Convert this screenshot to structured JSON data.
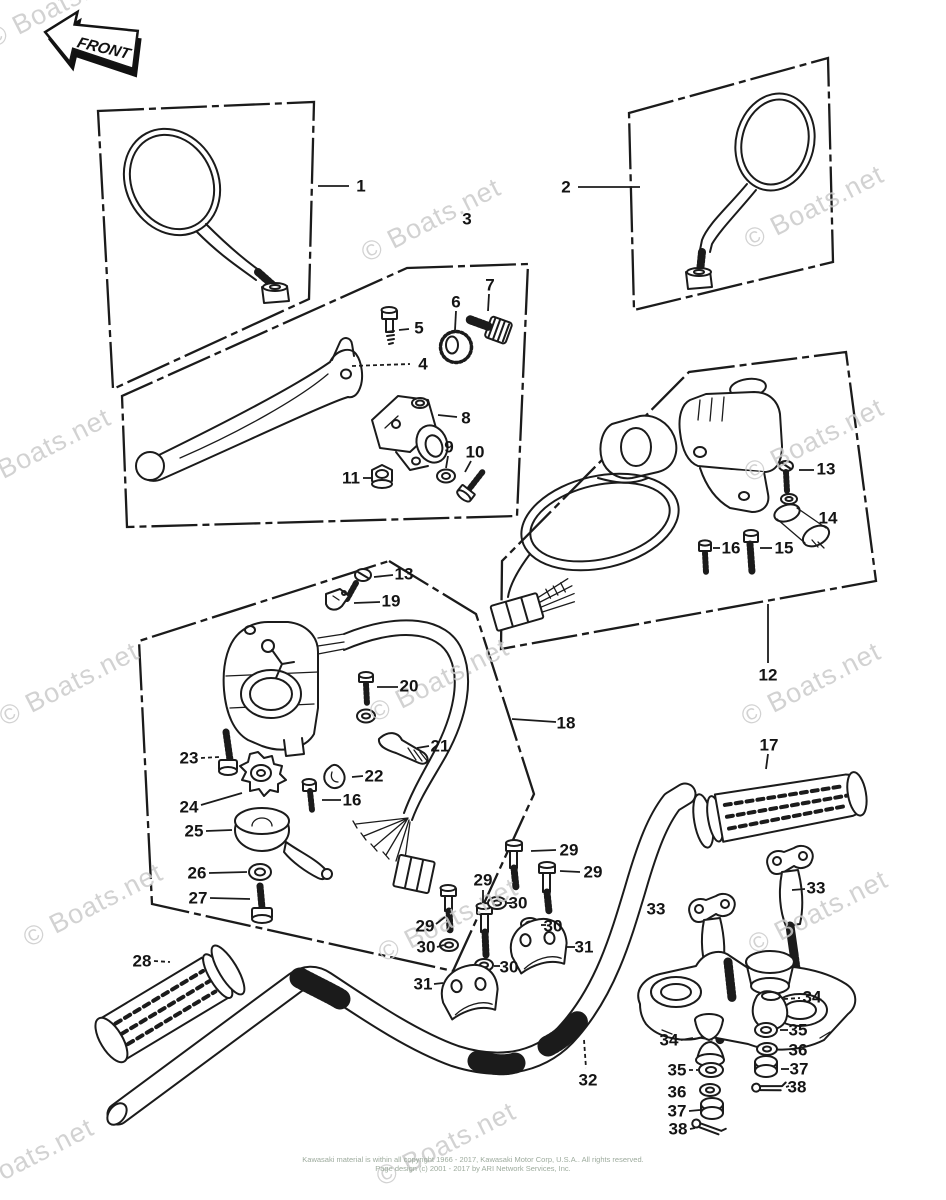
{
  "diagram": {
    "front_label": "FRONT",
    "watermark": {
      "text": "© Boats.net",
      "color": "#cbcbcb",
      "rotation": -27,
      "font_size": 27,
      "positions": [
        [
          60,
          14
        ],
        [
          435,
          228
        ],
        [
          818,
          215
        ],
        [
          45,
          458
        ],
        [
          818,
          448
        ],
        [
          73,
          692
        ],
        [
          443,
          688
        ],
        [
          815,
          692
        ],
        [
          97,
          913
        ],
        [
          452,
          928
        ],
        [
          822,
          920
        ],
        [
          450,
          1152
        ],
        [
          28,
          1168
        ]
      ]
    },
    "callout_style": {
      "color": "#141414",
      "font_size": 17
    },
    "callouts": [
      {
        "n": "1",
        "x": 361,
        "y": 186,
        "leader": [
          318,
          186,
          349,
          186
        ]
      },
      {
        "n": "2",
        "x": 566,
        "y": 187,
        "leader": [
          578,
          187,
          640,
          187
        ]
      },
      {
        "n": "3",
        "x": 467,
        "y": 219
      },
      {
        "n": "4",
        "x": 423,
        "y": 364,
        "leader": [
          352,
          366,
          410,
          364
        ],
        "dashed": true
      },
      {
        "n": "5",
        "x": 419,
        "y": 328,
        "leader": [
          399,
          330,
          409,
          329
        ]
      },
      {
        "n": "6",
        "x": 456,
        "y": 302,
        "leader": [
          456,
          311,
          455,
          330
        ]
      },
      {
        "n": "7",
        "x": 490,
        "y": 285,
        "leader": [
          489,
          294,
          488,
          311
        ]
      },
      {
        "n": "8",
        "x": 466,
        "y": 418,
        "leader": [
          438,
          415,
          457,
          417
        ]
      },
      {
        "n": "9",
        "x": 449,
        "y": 447,
        "leader": [
          448,
          456,
          446,
          468
        ]
      },
      {
        "n": "10",
        "x": 475,
        "y": 452,
        "leader": [
          471,
          461,
          465,
          472
        ]
      },
      {
        "n": "11",
        "x": 351,
        "y": 478,
        "leader": [
          363,
          478,
          371,
          478
        ]
      },
      {
        "n": "12",
        "x": 768,
        "y": 675,
        "leader": [
          768,
          604,
          768,
          663
        ]
      },
      {
        "n": "13",
        "x": 826,
        "y": 469,
        "leader": [
          799,
          470,
          814,
          470
        ]
      },
      {
        "n": "14",
        "x": 828,
        "y": 518
      },
      {
        "n": "15",
        "x": 784,
        "y": 548,
        "leader": [
          760,
          548,
          772,
          548
        ]
      },
      {
        "n": "16",
        "x": 731,
        "y": 548,
        "leader": [
          713,
          548,
          720,
          548
        ]
      },
      {
        "n": "13",
        "x": 404,
        "y": 574,
        "leader": [
          374,
          577,
          393,
          575
        ]
      },
      {
        "n": "19",
        "x": 391,
        "y": 601,
        "leader": [
          354,
          603,
          380,
          602
        ]
      },
      {
        "n": "20",
        "x": 409,
        "y": 686,
        "leader": [
          377,
          687,
          398,
          687
        ]
      },
      {
        "n": "21",
        "x": 440,
        "y": 746,
        "leader": [
          417,
          748,
          429,
          746
        ]
      },
      {
        "n": "22",
        "x": 374,
        "y": 776,
        "leader": [
          352,
          777,
          363,
          776
        ]
      },
      {
        "n": "16",
        "x": 352,
        "y": 800,
        "leader": [
          322,
          800,
          341,
          800
        ]
      },
      {
        "n": "23",
        "x": 189,
        "y": 758,
        "leader": [
          201,
          758,
          219,
          757
        ],
        "dashed": true
      },
      {
        "n": "24",
        "x": 189,
        "y": 807,
        "leader": [
          201,
          805,
          242,
          793
        ]
      },
      {
        "n": "25",
        "x": 194,
        "y": 831,
        "leader": [
          206,
          831,
          232,
          830
        ]
      },
      {
        "n": "26",
        "x": 197,
        "y": 873,
        "leader": [
          209,
          873,
          247,
          872
        ]
      },
      {
        "n": "27",
        "x": 198,
        "y": 898,
        "leader": [
          210,
          898,
          250,
          899
        ]
      },
      {
        "n": "28",
        "x": 142,
        "y": 961,
        "leader": [
          154,
          961,
          170,
          962
        ],
        "dashed": true
      },
      {
        "n": "29",
        "x": 569,
        "y": 850,
        "leader": [
          531,
          851,
          556,
          850
        ]
      },
      {
        "n": "29",
        "x": 593,
        "y": 872,
        "leader": [
          560,
          871,
          580,
          872
        ]
      },
      {
        "n": "29",
        "x": 483,
        "y": 880,
        "leader": [
          483,
          890,
          483,
          903
        ]
      },
      {
        "n": "29",
        "x": 425,
        "y": 926,
        "leader": [
          436,
          924,
          445,
          917
        ]
      },
      {
        "n": "30",
        "x": 426,
        "y": 947,
        "leader": [
          437,
          947,
          444,
          945
        ]
      },
      {
        "n": "30",
        "x": 518,
        "y": 903,
        "leader": [
          507,
          903,
          512,
          903
        ]
      },
      {
        "n": "30",
        "x": 553,
        "y": 926,
        "leader": [
          541,
          925,
          546,
          925
        ]
      },
      {
        "n": "30",
        "x": 509,
        "y": 967,
        "leader": [
          494,
          966,
          500,
          966
        ]
      },
      {
        "n": "31",
        "x": 423,
        "y": 984,
        "leader": [
          434,
          984,
          443,
          983
        ]
      },
      {
        "n": "31",
        "x": 584,
        "y": 947,
        "leader": [
          566,
          947,
          575,
          947
        ]
      },
      {
        "n": "32",
        "x": 588,
        "y": 1080,
        "leader": [
          584,
          1040,
          586,
          1068
        ],
        "dashed": true
      },
      {
        "n": "33",
        "x": 656,
        "y": 909
      },
      {
        "n": "33",
        "x": 816,
        "y": 888,
        "leader": [
          792,
          890,
          805,
          889
        ]
      },
      {
        "n": "34",
        "x": 669,
        "y": 1040,
        "leader": [
          681,
          1040,
          693,
          1038
        ]
      },
      {
        "n": "34",
        "x": 812,
        "y": 997,
        "leader": [
          784,
          999,
          800,
          998
        ],
        "dashed": true
      },
      {
        "n": "35",
        "x": 677,
        "y": 1070,
        "leader": [
          689,
          1070,
          698,
          1070
        ],
        "dashed": true
      },
      {
        "n": "36",
        "x": 677,
        "y": 1092
      },
      {
        "n": "37",
        "x": 677,
        "y": 1111,
        "leader": [
          689,
          1111,
          700,
          1110
        ]
      },
      {
        "n": "38",
        "x": 678,
        "y": 1129,
        "leader": [
          690,
          1129,
          695,
          1128
        ]
      },
      {
        "n": "35",
        "x": 798,
        "y": 1030,
        "leader": [
          780,
          1030,
          788,
          1030
        ]
      },
      {
        "n": "36",
        "x": 798,
        "y": 1050
      },
      {
        "n": "37",
        "x": 799,
        "y": 1069,
        "leader": [
          781,
          1069,
          789,
          1069
        ]
      },
      {
        "n": "38",
        "x": 797,
        "y": 1087,
        "leader": [
          786,
          1087,
          789,
          1086
        ]
      },
      {
        "n": "17",
        "x": 769,
        "y": 745,
        "leader": [
          768,
          754,
          766,
          769
        ]
      },
      {
        "n": "18",
        "x": 566,
        "y": 723,
        "leader": [
          512,
          719,
          556,
          722
        ]
      }
    ]
  },
  "footer": {
    "line1": "Kawasaki material is within all copyright 1966 - 2017, Kawasaki Motor Corp, U.S.A.. All rights reserved.",
    "line2": "Page design (c) 2001 - 2017 by ARI Network Services, Inc."
  }
}
